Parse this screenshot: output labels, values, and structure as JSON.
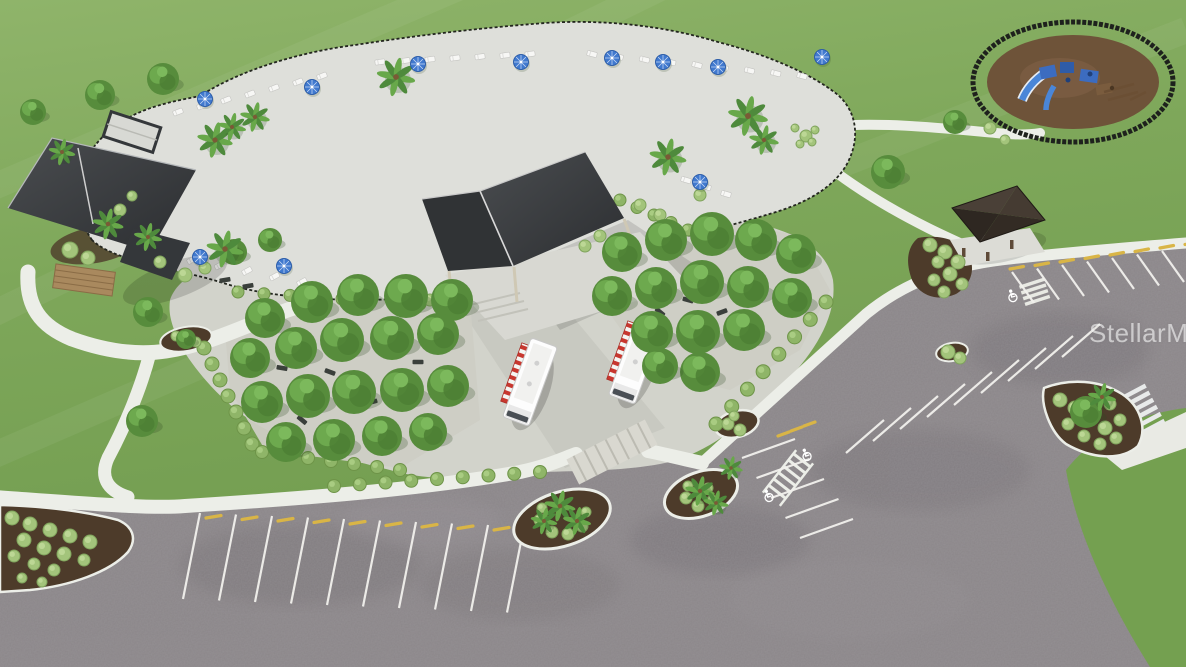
{
  "image": {
    "type": "aerial-3d-architectural-rendering",
    "description": "Aerial 3D rendering of a community amenity center: freeform resort pool with lounge chairs and blue umbrellas, clubhouse, open-air event pavilion, two food trucks, shaded tree groves with seating, fenced playground, gazebo, walking paths and a large parking lot with accessible spaces",
    "watermark": "StellarMLS"
  },
  "scene": {
    "elements": [
      {
        "id": "pool",
        "label": "Freeform swimming pool"
      },
      {
        "id": "pool-deck",
        "label": "Pool deck with lounge chairs and umbrellas"
      },
      {
        "id": "clubhouse",
        "label": "Clubhouse building"
      },
      {
        "id": "event-pavilion",
        "label": "Open-air event pavilion"
      },
      {
        "id": "food-trucks",
        "label": "Food trucks",
        "count": 2
      },
      {
        "id": "tree-groves",
        "label": "Tree groves with benches and picnic tables"
      },
      {
        "id": "playground",
        "label": "Fenced playground with blue play structure"
      },
      {
        "id": "gazebo",
        "label": "Gazebo"
      },
      {
        "id": "parking-lot",
        "label": "Parking lot with accessible stalls and crosswalks"
      },
      {
        "id": "walking-paths",
        "label": "Curving concrete walking paths"
      },
      {
        "id": "lawn",
        "label": "Open lawn"
      }
    ]
  },
  "colors": {
    "grass": "#7ea75a",
    "grass_light": "#8fb46a",
    "water": "#7fb0c4",
    "water_deep": "#5d90a9",
    "pool_deck": "#dedfda",
    "path": "#eceee8",
    "asphalt": "#8b8689",
    "asphalt_shadow": "#6e696c",
    "roof_dark": "#3a3d40",
    "gazebo_roof": "#3a322a",
    "mulch": "#4d3b2a",
    "playground_mulch": "#6e5339",
    "playground_blue": "#3c6cc0",
    "tree_green": "#578c3c",
    "shrub_green": "#a3c47b",
    "umbrella_blue": "#4079cf",
    "truck_white": "#fdfdfd",
    "awning_red": "#c8372f",
    "stall_marking": "#f2f1ed",
    "wheel_stop_yellow": "#d9b546",
    "fence_black": "#23261f",
    "watermark_text": "rgba(255,255,255,0.58)"
  }
}
